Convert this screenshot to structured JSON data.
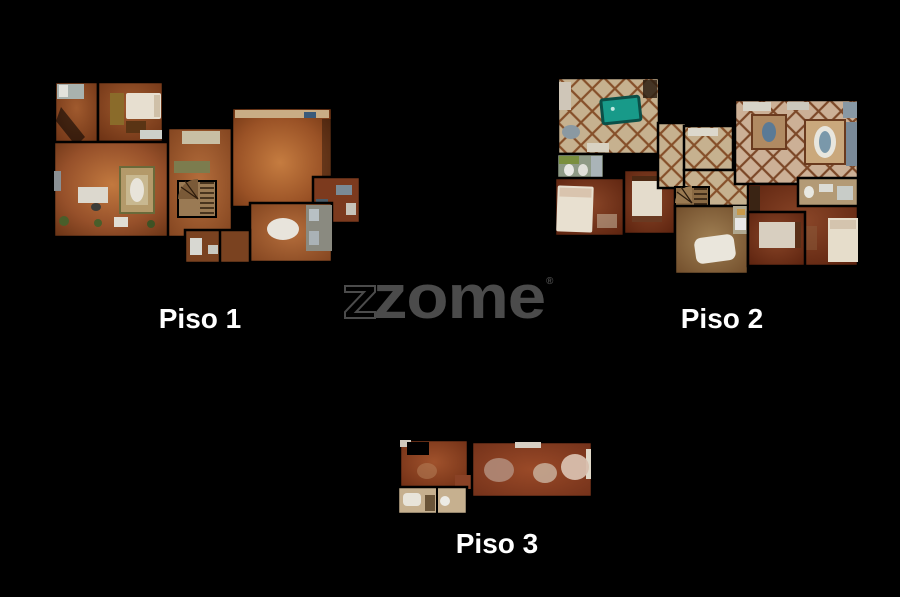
{
  "background": "#000000",
  "watermark": {
    "text": "zome",
    "registered": "®",
    "color": "#4b4b4b"
  },
  "floors": [
    {
      "id": "piso-1",
      "label": "Piso 1"
    },
    {
      "id": "piso-2",
      "label": "Piso 2"
    },
    {
      "id": "piso-3",
      "label": "Piso 3"
    }
  ]
}
